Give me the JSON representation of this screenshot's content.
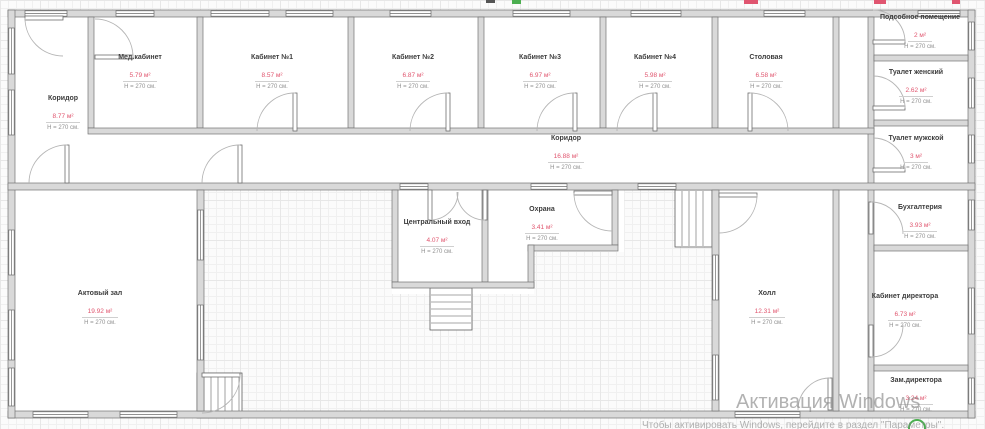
{
  "colors": {
    "wall_fill": "#d9d9d9",
    "wall_stroke": "#737373",
    "room_name": "#3d3d3d",
    "area_value": "#e0556e",
    "room_height": "#8f8f8f",
    "door_arc": "#b5b5b5",
    "watermark": "#828282",
    "artifact_green": "#4caf50",
    "artifact_red": "#e05570"
  },
  "watermark": {
    "title": "Активация Windows",
    "subtitle": "Чтобы активировать Windows, перейдите в раздел \"Параметры\"."
  },
  "rooms": [
    {
      "name": "Коридор",
      "area": "8.77 м²",
      "height": "H = 270 см."
    },
    {
      "name": "Мед.кабинет",
      "area": "5.79 м²",
      "height": "H = 270 см."
    },
    {
      "name": "Кабинет №1",
      "area": "8.57 м²",
      "height": "H = 270 см."
    },
    {
      "name": "Кабинет №2",
      "area": "6.87 м²",
      "height": "H = 270 см."
    },
    {
      "name": "Кабинет №3",
      "area": "6.97 м²",
      "height": "H = 270 см."
    },
    {
      "name": "Кабинет №4",
      "area": "5.98 м²",
      "height": "H = 270 см."
    },
    {
      "name": "Столовая",
      "area": "6.58 м²",
      "height": "H = 270 см."
    },
    {
      "name": "Подсобное помещение",
      "area": "2 м²",
      "height": "H = 270 см."
    },
    {
      "name": "Туалет женский",
      "area": "2.62 м²",
      "height": "H = 270 см."
    },
    {
      "name": "Туалет мужской",
      "area": "3 м²",
      "height": "H = 270 см."
    },
    {
      "name": "Коридор",
      "area": "16.88 м²",
      "height": "H = 270 см."
    },
    {
      "name": "Центральный вход",
      "area": "4.07 м²",
      "height": "H = 270 см."
    },
    {
      "name": "Охрана",
      "area": "3.41 м²",
      "height": "H = 270 см."
    },
    {
      "name": "Актовый зал",
      "area": "19.92 м²",
      "height": "H = 270 см."
    },
    {
      "name": "Холл",
      "area": "12.31 м²",
      "height": "H = 270 см."
    },
    {
      "name": "Бухгалтерия",
      "area": "3.93 м²",
      "height": "H = 270 см."
    },
    {
      "name": "Кабинет директора",
      "area": "6.73 м²",
      "height": "H = 270 см."
    },
    {
      "name": "Зам.директора",
      "area": "3.24 м²",
      "height": "H = 270 см."
    }
  ]
}
